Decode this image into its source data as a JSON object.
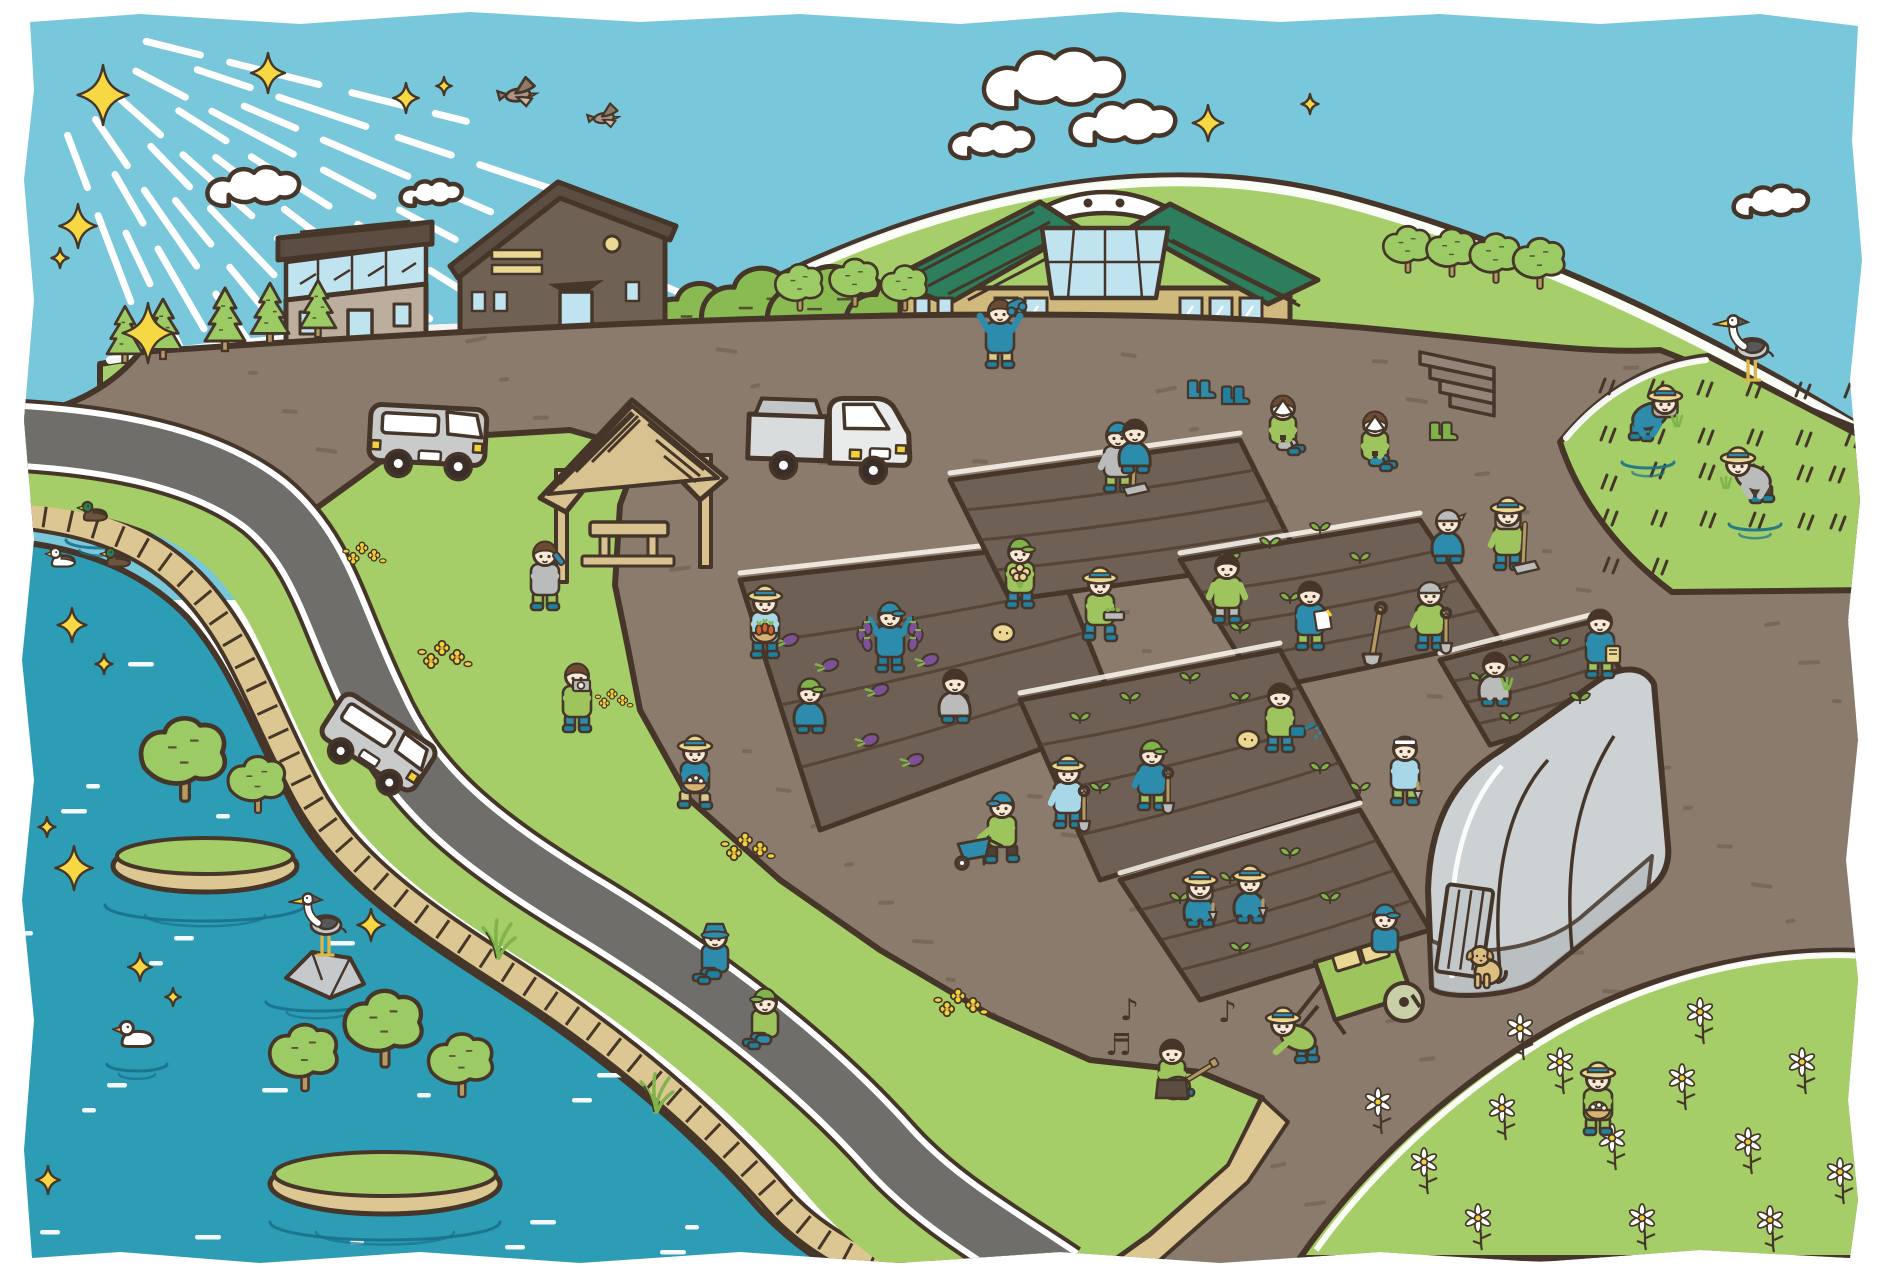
{
  "meta": {
    "description": "hand-drawn illustration of a community farm scene by a river",
    "canvas_w": 1881,
    "canvas_h": 1278
  },
  "palette": {
    "outline": "#46362a",
    "sky": "#79c7db",
    "ray": "#ffffff",
    "cloud": "#ffffff",
    "sparkle": "#f6d844",
    "hill": "#a6cf6c",
    "hillband": "#9cc75e",
    "bush": "#8abb53",
    "tree": "#9cca64",
    "grass": "#a5cd68",
    "soil": "#8b7b6c",
    "speck": "#6b5b4c",
    "plot": "#6e6054",
    "furrow": "#4e3e30",
    "pathline": "#fdf9f1",
    "road": "#6f6e6a",
    "roadline": "#ffffff",
    "water": "#2d9cb5",
    "ripple": "#ffffff",
    "ring": "#19718a",
    "embank": "#dcc691",
    "wood": "#d8c290",
    "wooddark": "#b69a64",
    "straw": "#ead792",
    "roofg": "#2c7e5c",
    "wallc": "#cfb97d",
    "barnwall": "#6f6154",
    "barnroof": "#5c4d42",
    "winblue": "#bfe3ef",
    "grayv": "#c9cbca",
    "white": "#ffffff",
    "yellow": "#f2d23c",
    "skin": "#f8e9d6",
    "hairbrown": "#6d4b33",
    "hairdark": "#483428",
    "hairgray": "#b5b1a8",
    "green1": "#9dc45d",
    "green2": "#80b44b",
    "blue1": "#2d8cac",
    "teal": "#20809f",
    "lblue": "#a8d8e8",
    "grayc": "#b9bcba",
    "khaki": "#dac98f",
    "darkp": "#4c4038",
    "purple": "#7d5198",
    "carrot": "#d2622a",
    "dogc": "#dcbd82",
    "basketc": "#d8b272",
    "heron1": "#c6c9cb",
    "heron2": "#55575a",
    "ghouse": "#ccd1d3",
    "ghouse2": "#b7bcbf",
    "stone": "#c6c9cb"
  },
  "scene": {
    "sun_rays": {
      "count": 13
    },
    "sparkles": [
      {
        "x": 103,
        "y": 95,
        "s": 1.5
      },
      {
        "x": 268,
        "y": 73,
        "s": 1.0
      },
      {
        "x": 406,
        "y": 98,
        "s": 0.75
      },
      {
        "x": 444,
        "y": 86,
        "s": 0.45
      },
      {
        "x": 78,
        "y": 226,
        "s": 1.1
      },
      {
        "x": 148,
        "y": 333,
        "s": 1.5
      },
      {
        "x": 60,
        "y": 258,
        "s": 0.5
      },
      {
        "x": 1208,
        "y": 123,
        "s": 0.9
      },
      {
        "x": 1310,
        "y": 104,
        "s": 0.5
      },
      {
        "x": 72,
        "y": 625,
        "s": 0.85
      },
      {
        "x": 104,
        "y": 664,
        "s": 0.5
      },
      {
        "x": 47,
        "y": 827,
        "s": 0.5
      },
      {
        "x": 74,
        "y": 868,
        "s": 1.1
      },
      {
        "x": 140,
        "y": 967,
        "s": 0.7
      },
      {
        "x": 173,
        "y": 997,
        "s": 0.45
      },
      {
        "x": 371,
        "y": 925,
        "s": 0.8
      },
      {
        "x": 48,
        "y": 1180,
        "s": 0.7
      }
    ],
    "clouds": [
      {
        "x": 277,
        "y": 197,
        "s": 1.05
      },
      {
        "x": 447,
        "y": 200,
        "s": 0.7
      },
      {
        "x": 1013,
        "y": 150,
        "s": 0.95
      },
      {
        "x": 1090,
        "y": 95,
        "s": 1.6
      },
      {
        "x": 1150,
        "y": 135,
        "s": 1.2
      },
      {
        "x": 1790,
        "y": 210,
        "s": 0.85
      }
    ],
    "birds": [
      {
        "x": 518,
        "y": 95,
        "s": 1.1
      },
      {
        "x": 604,
        "y": 118,
        "s": 0.9
      }
    ],
    "conifers": [
      {
        "x": 125,
        "y": 362,
        "s": 0.9
      },
      {
        "x": 163,
        "y": 358,
        "s": 0.95
      },
      {
        "x": 225,
        "y": 350,
        "s": 1.0
      },
      {
        "x": 270,
        "y": 342,
        "s": 0.95
      },
      {
        "x": 318,
        "y": 336,
        "s": 0.9
      }
    ],
    "round_trees": [
      {
        "x": 800,
        "y": 310,
        "s": 0.7
      },
      {
        "x": 855,
        "y": 306,
        "s": 0.72
      },
      {
        "x": 905,
        "y": 310,
        "s": 0.68
      },
      {
        "x": 1408,
        "y": 272,
        "s": 0.7
      },
      {
        "x": 1452,
        "y": 276,
        "s": 0.72
      },
      {
        "x": 1496,
        "y": 282,
        "s": 0.74
      },
      {
        "x": 1540,
        "y": 288,
        "s": 0.76
      },
      {
        "x": 185,
        "y": 800,
        "s": 1.25
      },
      {
        "x": 258,
        "y": 812,
        "s": 0.85
      },
      {
        "x": 305,
        "y": 1090,
        "s": 1.0
      },
      {
        "x": 385,
        "y": 1066,
        "s": 1.15
      },
      {
        "x": 462,
        "y": 1096,
        "s": 0.95
      }
    ],
    "bushes": [
      {
        "x": 700,
        "y": 328,
        "s": 1.2
      },
      {
        "x": 762,
        "y": 322,
        "s": 1.45
      },
      {
        "x": 832,
        "y": 324,
        "s": 1.55
      },
      {
        "x": 902,
        "y": 327,
        "s": 1.35
      },
      {
        "x": 952,
        "y": 330,
        "s": 1.0
      },
      {
        "x": 1392,
        "y": 398,
        "s": 1.2
      },
      {
        "x": 1478,
        "y": 404,
        "s": 1.3
      },
      {
        "x": 1562,
        "y": 410,
        "s": 1.2
      },
      {
        "x": 1645,
        "y": 418,
        "s": 1.1
      }
    ],
    "yellow_flowers": [
      {
        "x": 362,
        "y": 548,
        "s": 0.8
      },
      {
        "x": 442,
        "y": 648,
        "s": 1.0
      },
      {
        "x": 745,
        "y": 840,
        "s": 1.0
      },
      {
        "x": 958,
        "y": 996,
        "s": 1.0
      },
      {
        "x": 612,
        "y": 694,
        "s": 0.7
      }
    ],
    "daisies": [
      {
        "x": 1378,
        "y": 1102
      },
      {
        "x": 1424,
        "y": 1162
      },
      {
        "x": 1502,
        "y": 1108
      },
      {
        "x": 1560,
        "y": 1062
      },
      {
        "x": 1612,
        "y": 1138
      },
      {
        "x": 1682,
        "y": 1078
      },
      {
        "x": 1748,
        "y": 1142
      },
      {
        "x": 1802,
        "y": 1062
      },
      {
        "x": 1840,
        "y": 1172
      },
      {
        "x": 1478,
        "y": 1218
      },
      {
        "x": 1642,
        "y": 1218
      },
      {
        "x": 1770,
        "y": 1220
      },
      {
        "x": 1520,
        "y": 1028
      },
      {
        "x": 1700,
        "y": 1012
      }
    ],
    "sprouts": [
      {
        "x": 1230,
        "y": 560
      },
      {
        "x": 1270,
        "y": 545
      },
      {
        "x": 1320,
        "y": 530
      },
      {
        "x": 1360,
        "y": 560
      },
      {
        "x": 1290,
        "y": 600
      },
      {
        "x": 1240,
        "y": 630
      },
      {
        "x": 1080,
        "y": 720
      },
      {
        "x": 1130,
        "y": 700
      },
      {
        "x": 1190,
        "y": 680
      },
      {
        "x": 1240,
        "y": 700
      },
      {
        "x": 1150,
        "y": 760
      },
      {
        "x": 1100,
        "y": 790
      },
      {
        "x": 1480,
        "y": 680
      },
      {
        "x": 1520,
        "y": 662
      },
      {
        "x": 1560,
        "y": 645
      },
      {
        "x": 1580,
        "y": 700
      },
      {
        "x": 1510,
        "y": 720
      },
      {
        "x": 1180,
        "y": 900
      },
      {
        "x": 1230,
        "y": 880
      },
      {
        "x": 1290,
        "y": 855
      },
      {
        "x": 1330,
        "y": 900
      },
      {
        "x": 1240,
        "y": 950
      },
      {
        "x": 1320,
        "y": 770
      },
      {
        "x": 1360,
        "y": 790
      }
    ],
    "eggplants_ground": [
      {
        "x": 790,
        "y": 640
      },
      {
        "x": 830,
        "y": 665
      },
      {
        "x": 880,
        "y": 690
      },
      {
        "x": 930,
        "y": 660
      },
      {
        "x": 960,
        "y": 700
      },
      {
        "x": 870,
        "y": 740
      },
      {
        "x": 915,
        "y": 760
      }
    ],
    "potatoes": [
      {
        "x": 1003,
        "y": 633
      },
      {
        "x": 1248,
        "y": 740
      }
    ],
    "boots_pairs": [
      {
        "x": 1188,
        "y": 398,
        "c": "blue1"
      },
      {
        "x": 1222,
        "y": 404,
        "c": "teal"
      },
      {
        "x": 1430,
        "y": 440,
        "c": "green2"
      }
    ],
    "ducks": [
      {
        "x": 95,
        "y": 518,
        "s": 0.85,
        "kind": "mallard"
      },
      {
        "x": 63,
        "y": 564,
        "s": 0.85,
        "kind": "pied"
      },
      {
        "x": 118,
        "y": 564,
        "s": 0.85,
        "kind": "mallard"
      },
      {
        "x": 137,
        "y": 1043,
        "s": 1.15,
        "kind": "white"
      }
    ],
    "herons": [
      {
        "x": 322,
        "y": 955,
        "s": 1.0
      },
      {
        "x": 1748,
        "y": 380,
        "s": 1.05
      }
    ],
    "dog": {
      "x": 1486,
      "y": 988,
      "s": 1.0
    },
    "reeds": [
      {
        "x": 497,
        "y": 958
      },
      {
        "x": 655,
        "y": 1112
      }
    ],
    "music_notes": [
      {
        "x": 1120,
        "y": 1020,
        "glyph": "♪"
      },
      {
        "x": 1105,
        "y": 1055,
        "glyph": "♬"
      },
      {
        "x": 1218,
        "y": 1022,
        "glyph": "♪"
      }
    ],
    "people": [
      {
        "name": "binoculars-kid",
        "x": 1000,
        "y": 368,
        "pose": "stand",
        "shirt": "blue1",
        "pants": "khaki",
        "hat": "none",
        "hair": "hairbrown",
        "prop": "binoculars"
      },
      {
        "name": "drinking-man",
        "x": 545,
        "y": 610,
        "pose": "stand",
        "shirt": "grayc",
        "pants": "green1",
        "hat": "none",
        "hair": "hairbrown",
        "prop": "bottle"
      },
      {
        "name": "camera-kid",
        "x": 577,
        "y": 732,
        "pose": "stand",
        "shirt": "green1",
        "pants": "blue1",
        "hat": "none",
        "hair": "hairbrown",
        "prop": "camera"
      },
      {
        "name": "carrot-basket-woman",
        "x": 765,
        "y": 658,
        "pose": "stand",
        "shirt": "lblue",
        "pants": "teal",
        "hat": "straw",
        "hair": "hairbrown",
        "prop": "carrots"
      },
      {
        "name": "eggplant-boy",
        "x": 890,
        "y": 672,
        "pose": "stand",
        "shirt": "blue1",
        "pants": "teal",
        "hat": "capblue",
        "hair": "khaki",
        "prop": "eggplants"
      },
      {
        "name": "picking-kid",
        "x": 810,
        "y": 732,
        "pose": "crouch",
        "shirt": "blue1",
        "pants": "green1",
        "hat": "capgreen",
        "hair": "hairbrown"
      },
      {
        "name": "picking-person",
        "x": 955,
        "y": 722,
        "pose": "crouch",
        "shirt": "grayc",
        "pants": "blue1",
        "hat": "none",
        "hair": "hairdark"
      },
      {
        "name": "flower-bunch-man",
        "x": 1020,
        "y": 608,
        "pose": "stand",
        "shirt": "green1",
        "pants": "blue1",
        "hat": "capgreen",
        "hair": "hairbrown",
        "prop": "bouquet"
      },
      {
        "name": "hoe-boy",
        "x": 1118,
        "y": 492,
        "pose": "stand",
        "shirt": "grayc",
        "pants": "green1",
        "hat": "capblue",
        "hair": "hairbrown",
        "prop": "hoe"
      },
      {
        "name": "eating-boy",
        "x": 1283,
        "y": 456,
        "pose": "sit",
        "shirt": "green1",
        "pants": "grayc",
        "hat": "none",
        "hair": "hairbrown",
        "prop": "onigiri"
      },
      {
        "name": "eating-man",
        "x": 1375,
        "y": 472,
        "pose": "sit",
        "shirt": "green1",
        "pants": "blue1",
        "hat": "none",
        "hair": "hairbrown",
        "prop": "onigiri"
      },
      {
        "name": "tray-kid",
        "x": 1100,
        "y": 640,
        "pose": "walk",
        "shirt": "green1",
        "pants": "blue1",
        "hat": "straw",
        "hair": "hairbrown",
        "prop": "tray"
      },
      {
        "name": "pointing-boy",
        "x": 1227,
        "y": 623,
        "pose": "stand",
        "shirt": "green1",
        "pants": "grayc",
        "hat": "none",
        "hair": "hairdark"
      },
      {
        "name": "notebook-girl",
        "x": 1310,
        "y": 650,
        "pose": "stand",
        "shirt": "blue1",
        "pants": "green1",
        "hat": "none",
        "hair": "hairdark",
        "prop": "notebook"
      },
      {
        "name": "shovel-bandana-man",
        "x": 1430,
        "y": 650,
        "pose": "stand",
        "shirt": "green1",
        "pants": "blue1",
        "hat": "bandana",
        "hair": "none",
        "prop": "shovel"
      },
      {
        "name": "crouching-kid-2",
        "x": 1135,
        "y": 472,
        "pose": "crouch",
        "shirt": "blue1",
        "pants": "green1",
        "hat": "none",
        "hair": "hairdark"
      },
      {
        "name": "shovel-straw-woman",
        "x": 1068,
        "y": 828,
        "pose": "stand",
        "shirt": "lblue",
        "pants": "blue1",
        "hat": "straw",
        "hair": "khaki",
        "prop": "shovel"
      },
      {
        "name": "shovel-cap-boy",
        "x": 1152,
        "y": 810,
        "pose": "stand",
        "shirt": "blue1",
        "pants": "green1",
        "hat": "capgreen",
        "hair": "hairbrown",
        "prop": "shovel"
      },
      {
        "name": "planting-grandma",
        "x": 1200,
        "y": 926,
        "pose": "crouch",
        "shirt": "blue1",
        "pants": "green1",
        "hat": "straw",
        "hair": "hairgray",
        "longhair": true,
        "prop": "trowel"
      },
      {
        "name": "wheelbarrow-woman",
        "x": 1002,
        "y": 862,
        "pose": "walk",
        "dir": -1,
        "shirt": "green1",
        "pants": "darkp",
        "hat": "capblue",
        "hair": "hairbrown",
        "prop": "wheelbarrow"
      },
      {
        "name": "bank-kid-1",
        "x": 715,
        "y": 985,
        "pose": "sit",
        "dir": -1,
        "shirt": "blue1",
        "pants": "teal",
        "hat": "bucket",
        "hair": "hairbrown"
      },
      {
        "name": "bank-kid-2",
        "x": 765,
        "y": 1050,
        "pose": "sit",
        "dir": -1,
        "shirt": "green1",
        "pants": "blue1",
        "hat": "capgreen",
        "hair": "hairdark"
      },
      {
        "name": "guitar-boy",
        "x": 1172,
        "y": 1100,
        "pose": "sit",
        "shirt": "green1",
        "pants": "blue1",
        "hat": "none",
        "hair": "hairdark",
        "prop": "guitar"
      },
      {
        "name": "basket-girl",
        "x": 695,
        "y": 808,
        "pose": "walk",
        "shirt": "blue1",
        "pants": "khaki",
        "hat": "straw",
        "hair": "green2",
        "prop": "basket"
      },
      {
        "name": "watering-girl",
        "x": 1280,
        "y": 752,
        "pose": "stand",
        "shirt": "green1",
        "pants": "blue1",
        "hat": "none",
        "hair": "hairdark",
        "prop": "watering"
      },
      {
        "name": "headband-boy",
        "x": 1405,
        "y": 805,
        "pose": "stand",
        "shirt": "lblue",
        "pants": "green1",
        "hat": "headband",
        "hair": "hairdark",
        "prop": "trowel"
      },
      {
        "name": "seedling-man",
        "x": 1495,
        "y": 705,
        "pose": "crouch",
        "shirt": "grayc",
        "pants": "green1",
        "hat": "none",
        "hair": "hairdark",
        "prop": "seedlings"
      },
      {
        "name": "seed-bag-man",
        "x": 1600,
        "y": 678,
        "pose": "stand",
        "shirt": "blue1",
        "pants": "green1",
        "hat": "none",
        "hair": "hairdark",
        "prop": "seedbag"
      },
      {
        "name": "trowel-straw-woman",
        "x": 1250,
        "y": 922,
        "pose": "crouch",
        "shirt": "blue1",
        "pants": "green1",
        "hat": "straw",
        "hair": "khaki",
        "prop": "trowel"
      },
      {
        "name": "rice-planter-1",
        "x": 1648,
        "y": 440,
        "pose": "bend",
        "shirt": "blue1",
        "pants": "blue1",
        "hat": "straw",
        "hair": "hairgray",
        "longhair": true,
        "prop": "seedlings"
      },
      {
        "name": "rice-planter-2",
        "x": 1755,
        "y": 502,
        "pose": "bend",
        "dir": -1,
        "shirt": "grayc",
        "pants": "darkp",
        "hat": "straw",
        "hair": "khaki",
        "prop": "seedlings"
      },
      {
        "name": "hoe-grandma",
        "x": 1508,
        "y": 570,
        "pose": "stand",
        "shirt": "green1",
        "pants": "blue1",
        "hat": "straw",
        "hair": "hairgray",
        "longhair": true,
        "prop": "hoe"
      },
      {
        "name": "crouching-bandana-man",
        "x": 1448,
        "y": 562,
        "pose": "crouch",
        "shirt": "blue1",
        "pants": "green1",
        "hat": "bandana",
        "hair": "none"
      },
      {
        "name": "daisy-field-girl",
        "x": 1598,
        "y": 1135,
        "pose": "stand",
        "shirt": "green1",
        "pants": "green1",
        "hat": "straw",
        "hair": "hairdark",
        "prop": "basket"
      },
      {
        "name": "cart-puller",
        "x": 1300,
        "y": 1062,
        "pose": "bend",
        "dir": -1,
        "shirt": "green1",
        "pants": "blue1",
        "hat": "straw",
        "hair": "hairbrown"
      },
      {
        "name": "cart-rider",
        "x": 1385,
        "y": 962,
        "pose": "torso",
        "shirt": "blue1",
        "pants": "blue1",
        "hat": "capblue",
        "hair": "hairdark"
      }
    ]
  }
}
